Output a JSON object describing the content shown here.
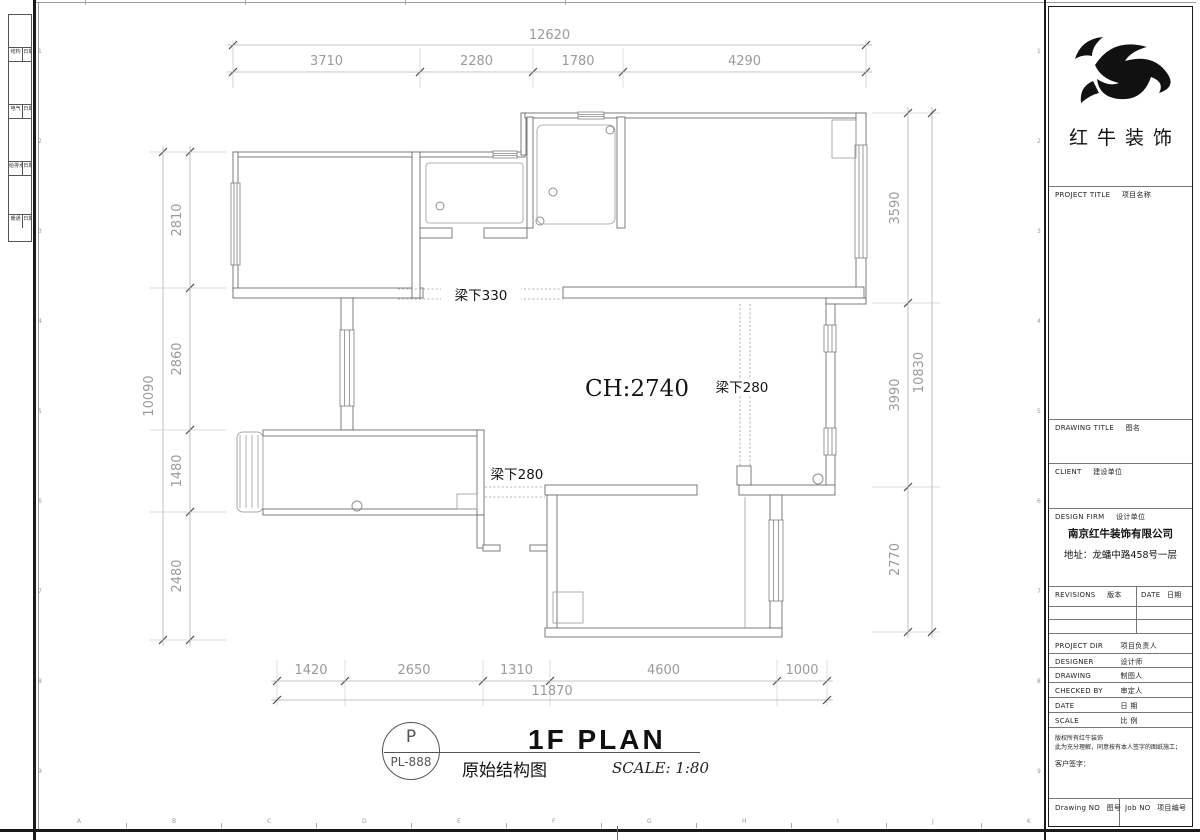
{
  "sheet": {
    "filing_rows": [
      {
        "a": "结构",
        "b": "日期"
      },
      {
        "a": "电气",
        "b": "日期"
      },
      {
        "a": "给排水",
        "b": "日期"
      },
      {
        "a": "暖通",
        "b": "日期"
      }
    ],
    "grid_letters": [
      "A",
      "B",
      "C",
      "D",
      "E",
      "F",
      "G",
      "H",
      "I",
      "J",
      "K"
    ],
    "grid_numbers": [
      "1",
      "2",
      "3",
      "4",
      "5",
      "6",
      "7",
      "8",
      "9"
    ]
  },
  "plan": {
    "ceiling_label": "CH:2740",
    "beam_label_330": "梁下330",
    "beam_label_280_right": "梁下280",
    "beam_label_280_left": "梁下280"
  },
  "dims": {
    "top": {
      "total": "12620",
      "segments": [
        "3710",
        "2280",
        "1780",
        "4290"
      ]
    },
    "bottom": {
      "total": "11870",
      "segments": [
        "1420",
        "2650",
        "1310",
        "4600",
        "1000"
      ]
    },
    "left": {
      "total": "10090",
      "segments": [
        "2810",
        "2860",
        "1480",
        "2480"
      ]
    },
    "right": {
      "total": "10830",
      "segments": [
        "3590",
        "3990",
        "2770"
      ]
    }
  },
  "title_bar": {
    "stamp_top": "P",
    "stamp_bottom": "PL-888",
    "plan_name": "1F PLAN",
    "drawing_name": "原始结构图",
    "scale": "SCALE: 1:80"
  },
  "title_block": {
    "brand": "红牛装饰",
    "project_title": {
      "en": "PROJECT TITLE",
      "cn": "项目名称"
    },
    "drawing_title": {
      "en": "DRAWING TITLE",
      "cn": "图名"
    },
    "client": {
      "en": "CLIENT",
      "cn": "建设单位"
    },
    "design_firm": {
      "en": "DESIGN FIRM",
      "cn": "设计单位"
    },
    "company": "南京红牛装饰有限公司",
    "address": "地址：龙蟠中路458号一层",
    "revisions": {
      "en": "REVISIONS",
      "cn": "版本"
    },
    "date_col": {
      "en": "DATE",
      "cn": "日期"
    },
    "fields": [
      {
        "en": "PROJECT DIR",
        "cn": "项目负责人"
      },
      {
        "en": "DESIGNER",
        "cn": "设计师"
      },
      {
        "en": "DRAWING",
        "cn": "制图人"
      },
      {
        "en": "CHECKED BY",
        "cn": "审定人"
      },
      {
        "en": "DATE",
        "cn": "日  期"
      },
      {
        "en": "SCALE",
        "cn": "比  例"
      }
    ],
    "disclaimer_1": "版权所有红牛装饰",
    "disclaimer_2": "此为充分理解，同意按有本人签字的图纸施工；",
    "customer_sign": "客户签字：",
    "drawing_no": {
      "en": "Drawing NO",
      "cn": "图号"
    },
    "job_no": {
      "en": "Job NO",
      "cn": "项目编号"
    }
  }
}
